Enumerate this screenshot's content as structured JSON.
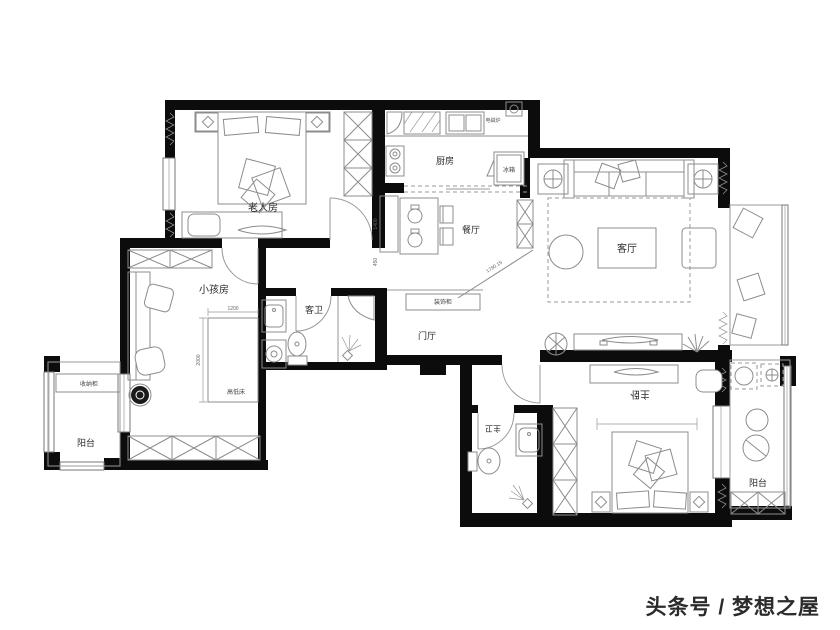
{
  "colors": {
    "wall": "#0c0c0c",
    "furniture_line": "#8c8c8c",
    "watermark": "#e8120c",
    "background": "#ffffff"
  },
  "rooms": {
    "elder_room": {
      "label": "老人房"
    },
    "kids_room": {
      "label": "小孩房"
    },
    "guest_bath": {
      "label": "客卫"
    },
    "kitchen": {
      "label": "厨房"
    },
    "dining": {
      "label": "餐厅"
    },
    "living": {
      "label": "客厅"
    },
    "foyer": {
      "label": "门厅"
    },
    "master_bedroom": {
      "label": "主卧"
    },
    "master_bath": {
      "label": "主卫"
    },
    "balcony_left": {
      "label": "阳台"
    },
    "balcony_right": {
      "label": "阳台"
    }
  },
  "annotations": {
    "storage_cabinet": "收纳柜",
    "bunk_bed": "高低床",
    "fridge": "冰箱",
    "decor_cabinet": "装饰柜",
    "induction_cooker": "电磁炉"
  },
  "dimensions": {
    "bunk_width": "1200",
    "bunk_length": "2000",
    "sideboard_length": "1400",
    "sideboard_depth": "450",
    "foyer_diagonal": "1790.15"
  },
  "watermark": {
    "text": "头条号 / 梦想之屋"
  }
}
